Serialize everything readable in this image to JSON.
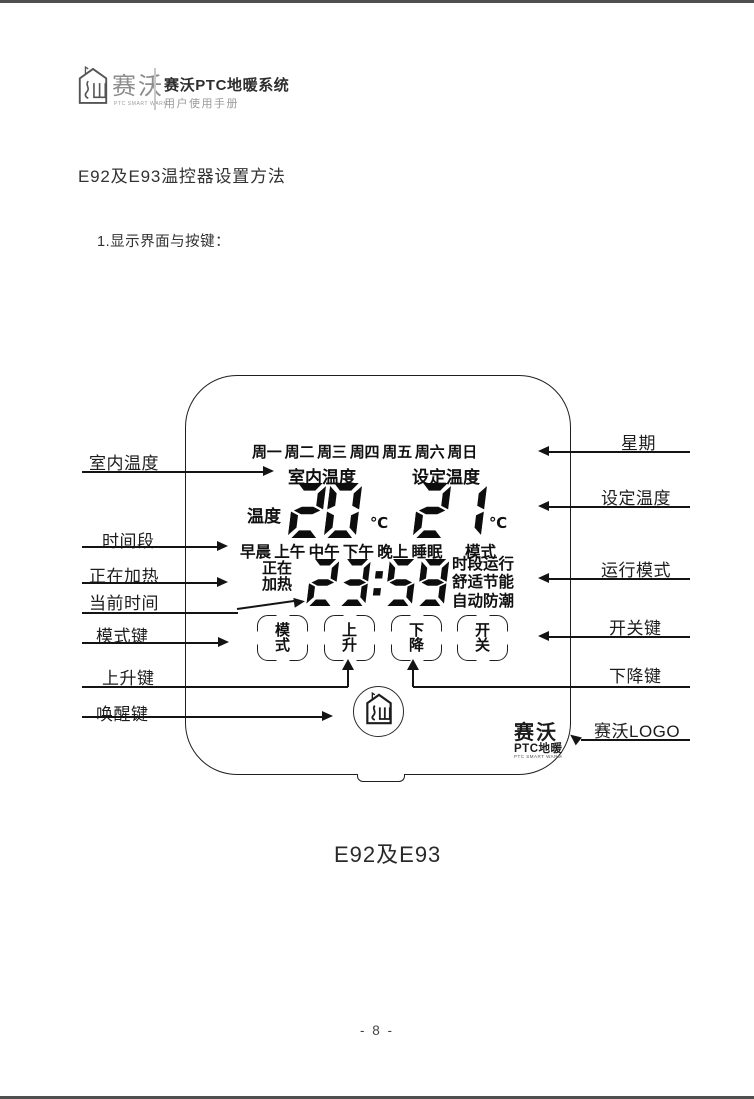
{
  "header": {
    "brand": "赛沃",
    "brand_tagline": "PTC SMART WARM",
    "title": "赛沃PTC地暖系统",
    "subtitle": "用户使用手册"
  },
  "headings": {
    "section_title": "E92及E93温控器设置方法",
    "step_title": "1.显示界面与按键："
  },
  "thermostat": {
    "week_row": "周一 周二 周三 周四 周五 周六 周日",
    "indoor_temp_label": "室内温度",
    "set_temp_label": "设定温度",
    "temp_prefix": "温度",
    "indoor_temp": "20",
    "set_temp": "21",
    "unit": "℃",
    "periods_row": "早晨 上午 中午 下午 晚上 睡眠",
    "mode_word": "模式",
    "heating_top": "正在",
    "heating_bottom": "加热",
    "current_time": "23:59",
    "mode_list": [
      "时段运行",
      "舒适节能",
      "自动防潮"
    ],
    "buttons": [
      {
        "top": "模",
        "bottom": "式"
      },
      {
        "top": "上",
        "bottom": "升"
      },
      {
        "top": "下",
        "bottom": "降"
      },
      {
        "top": "开",
        "bottom": "关"
      }
    ],
    "brand": "赛沃",
    "brand_sub": "PTC地暖",
    "brand_tagline": "PTC SMART WARM"
  },
  "callouts": {
    "left": [
      "室内温度",
      "时间段",
      "正在加热",
      "当前时间",
      "模式键",
      "上升键",
      "唤醒键"
    ],
    "right": [
      "星期",
      "设定温度",
      "运行模式",
      "开关键",
      "下降键",
      "赛沃LOGO"
    ]
  },
  "caption": "E92及E93",
  "footer": "- 8 -",
  "colors": {
    "ink": "#141414",
    "gray_text": "#9b9b9b",
    "edge_bar": "#4f4f4f"
  }
}
